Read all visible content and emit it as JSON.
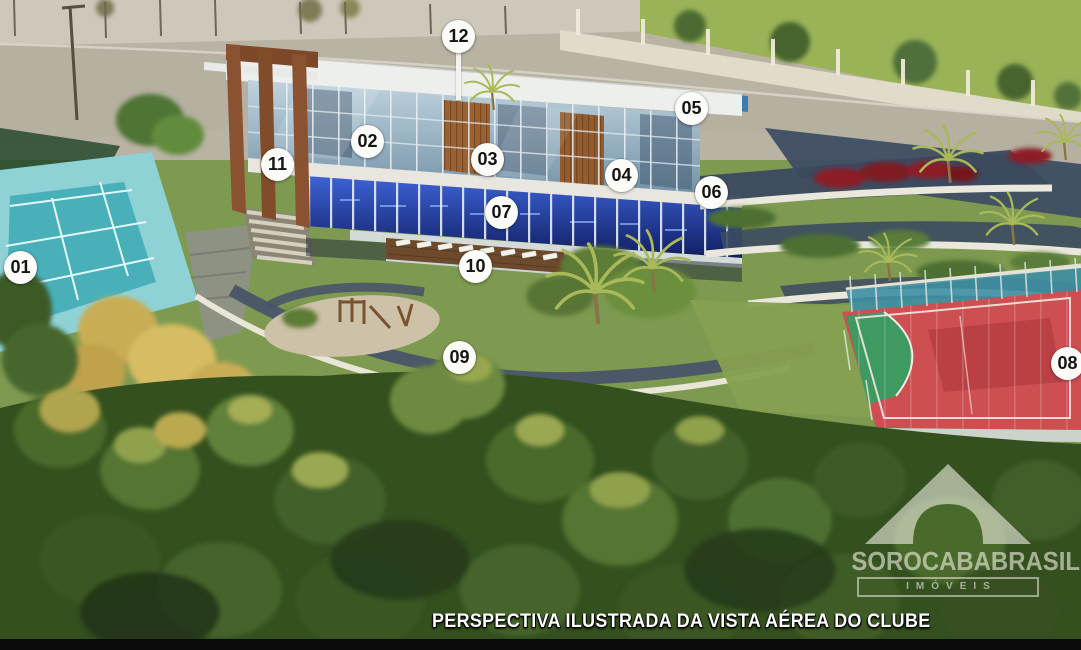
{
  "caption": {
    "text": "PERSPECTIVA ILUSTRADA DA VISTA AÉREA DO CLUBE"
  },
  "watermark": {
    "brand": "SOROCABABRASIL",
    "tagline": "IMÓVEIS"
  },
  "markers": [
    {
      "label": "01",
      "x": 20,
      "y": 267,
      "stem": false
    },
    {
      "label": "02",
      "x": 367,
      "y": 141,
      "stem": false
    },
    {
      "label": "03",
      "x": 487,
      "y": 159,
      "stem": false
    },
    {
      "label": "04",
      "x": 621,
      "y": 175,
      "stem": false
    },
    {
      "label": "05",
      "x": 691,
      "y": 108,
      "stem": false
    },
    {
      "label": "06",
      "x": 711,
      "y": 192,
      "stem": false
    },
    {
      "label": "07",
      "x": 501,
      "y": 212,
      "stem": false
    },
    {
      "label": "08",
      "x": 1067,
      "y": 363,
      "stem": false
    },
    {
      "label": "09",
      "x": 459,
      "y": 357,
      "stem": false
    },
    {
      "label": "10",
      "x": 475,
      "y": 266,
      "stem": false
    },
    {
      "label": "11",
      "x": 277,
      "y": 164,
      "stem": false
    },
    {
      "label": "12",
      "x": 458,
      "y": 36,
      "stem": true
    }
  ],
  "colors": {
    "marker_bg": "#fbfbf8",
    "marker_text": "#141414",
    "caption_text": "#ffffff",
    "watermark": "#f7f5ec",
    "road": "#b5b0a0",
    "grass": "#7d9a50",
    "forest": "#33501e",
    "tennis_court_outer": "#8ed2d6",
    "tennis_court_inner": "#49b0ba",
    "sport_court_red": "#cd4f52",
    "sport_court_green": "#3e9a60",
    "pool_blue": "#1d2f8a",
    "building_wood": "#8a5230",
    "roof_white": "#edefed",
    "path_slate": "#4a5468",
    "flower_red": "#8c1f26",
    "bottom_bar": "#0a0a0a"
  }
}
